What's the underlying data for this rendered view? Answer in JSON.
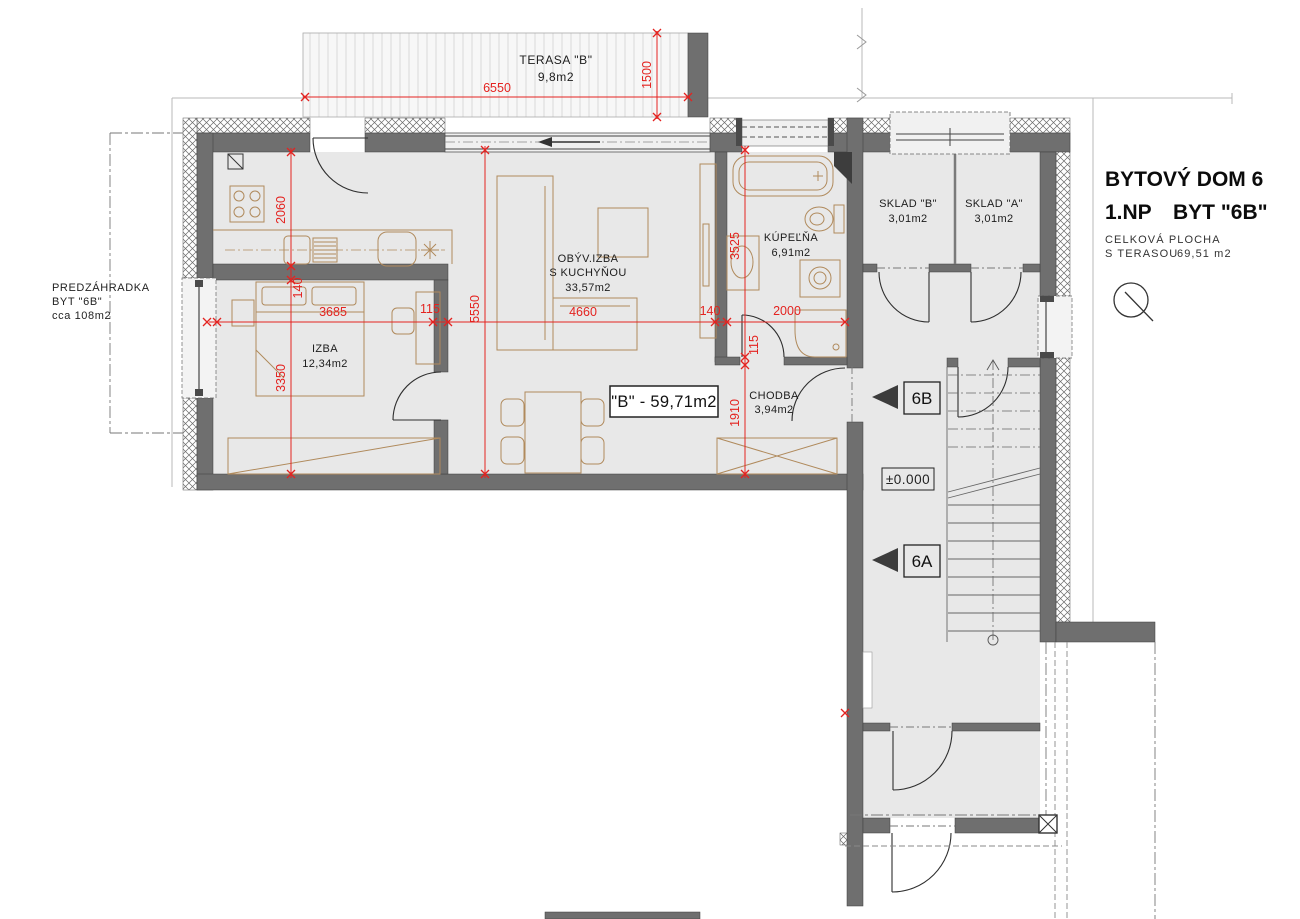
{
  "title_block": {
    "building": "BYTOVÝ DOM 6",
    "floor": "1.NP",
    "unit": "BYT \"6B\"",
    "area_note_line1": "CELKOVÁ PLOCHA",
    "area_note_line2": "S TERASOU",
    "total_area": "69,51 m2"
  },
  "plan": {
    "terrace": {
      "name": "TERASA \"B\"",
      "area": "9,8m2"
    },
    "front_garden": {
      "line1": "PREDZÁHRADKA",
      "line2": "BYT \"6B\"",
      "line3": "cca 108m2"
    },
    "rooms": {
      "living": {
        "line1": "OBÝV.IZBA",
        "line2": "S KUCHYŇOU",
        "area": "33,57m2"
      },
      "bedroom": {
        "name": "IZBA",
        "area": "12,34m2"
      },
      "bathroom": {
        "name": "KÚPEĽŇA",
        "area": "6,91m2"
      },
      "hallway": {
        "name": "CHODBA",
        "area": "3,94m2"
      },
      "storage_b": {
        "name": "SKLAD \"B\"",
        "area": "3,01m2"
      },
      "storage_a": {
        "name": "SKLAD \"A\"",
        "area": "3,01m2"
      }
    },
    "apartment_label": "\"B\" - 59,71m2",
    "markers": {
      "unit_b": "6B",
      "unit_a": "6A",
      "level": "±0.000"
    },
    "dimensions": {
      "terrace_width": "6550",
      "terrace_depth": "1500",
      "kitchen_depth": "2060",
      "wall_140a": "140",
      "bedroom_depth": "3350",
      "bedroom_width": "3685",
      "wall_115a": "115",
      "living_width": "4660",
      "wall_140b": "140",
      "bathroom_width": "2000",
      "living_depth": "5550",
      "bathroom_depth": "3525",
      "wall_115b": "115",
      "hallway_depth": "1910"
    },
    "colors": {
      "dimension_red": "#e42320",
      "wall_gray": "#6f6f6f",
      "furniture_tan": "#b08a5c",
      "room_fill": "#e8e8e8"
    }
  }
}
